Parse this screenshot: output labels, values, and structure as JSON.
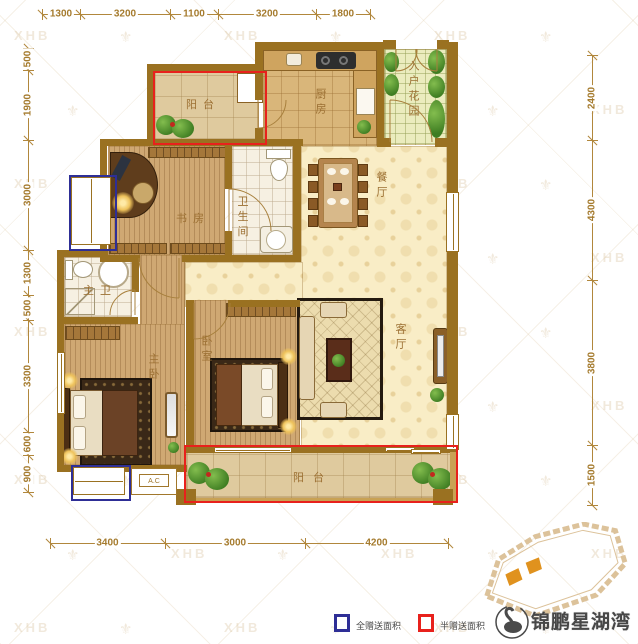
{
  "watermark": {
    "text": "XHB",
    "icon": "fleur-icon",
    "glyph": "⚜"
  },
  "dimensions": {
    "top": [
      "1300",
      "3200",
      "1100",
      "3200",
      "1800"
    ],
    "left": [
      "500",
      "1900",
      "3000",
      "1300",
      "500",
      "3300",
      "600",
      "900"
    ],
    "right": [
      "2400",
      "4300",
      "3800",
      "1500"
    ],
    "bottom": [
      "3400",
      "3000",
      "4200"
    ]
  },
  "rooms": {
    "top_balcony": "阳台",
    "kitchen": "厨房",
    "entry_garden": "入户花园",
    "dining": "餐厅",
    "study": "书房",
    "bathroom": "卫生间",
    "master_bath": "主卫",
    "master_bedroom": "主卧",
    "bedroom": "卧室",
    "living": "客厅",
    "bottom_balcony": "阳台"
  },
  "annotations": {
    "ac_label": "A.C"
  },
  "legend": {
    "full_gift": {
      "label": "全赠送面积",
      "color": "#2e2e96"
    },
    "half_gift": {
      "label": "半赠送面积",
      "color": "#e8211c"
    }
  },
  "logo": {
    "name": "锦鹏星湖湾"
  },
  "colors": {
    "wall": "#9a7121",
    "dimension": "#b1873c",
    "label": "#9c7033",
    "full_gift_blue": "#2e2e96",
    "half_gift_red": "#e8211c",
    "site_highlight": "#e0921e"
  }
}
